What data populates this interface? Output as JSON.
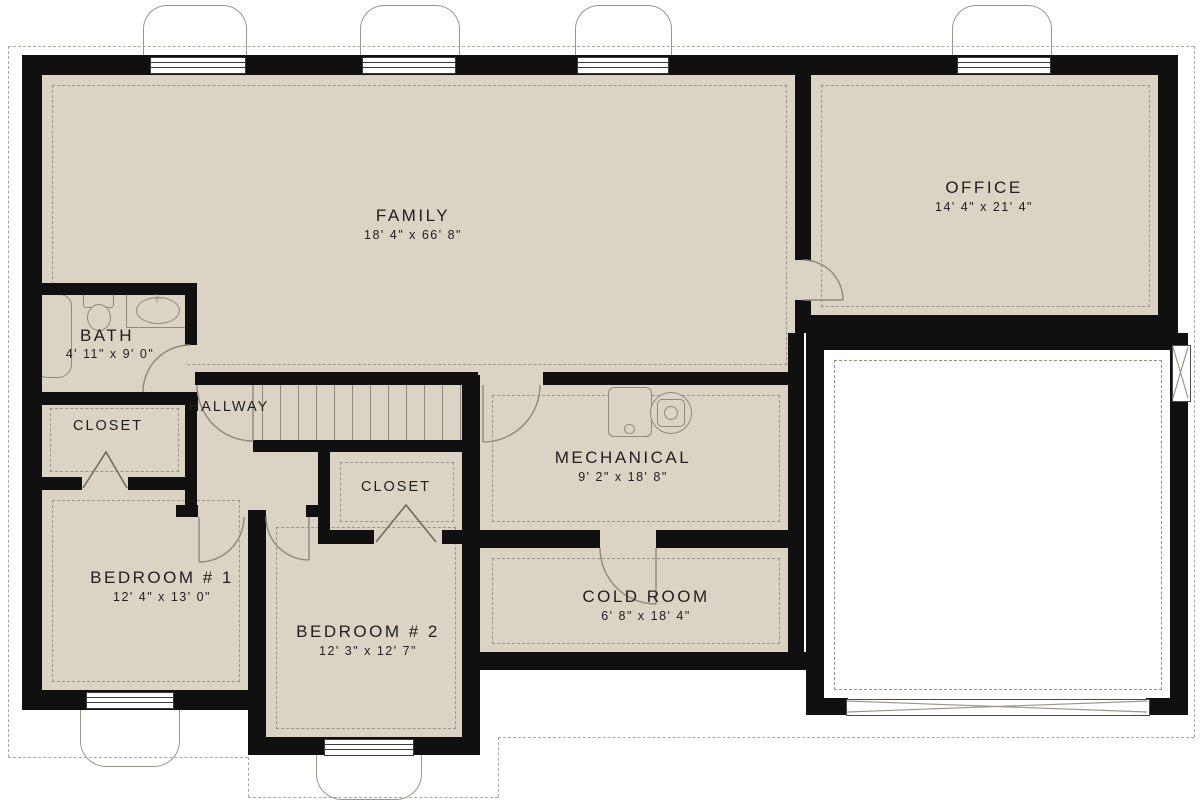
{
  "plan": {
    "type": "basement floor plan",
    "rooms": {
      "family": {
        "name": "FAMILY",
        "dims": "18' 4\" x 66' 8\""
      },
      "office": {
        "name": "OFFICE",
        "dims": "14' 4\" x 21' 4\""
      },
      "bath": {
        "name": "BATH",
        "dims": "4' 11\" x 9' 0\""
      },
      "closet_left": {
        "name": "CLOSET"
      },
      "hallway": {
        "name": "HALLWAY"
      },
      "closet_middle": {
        "name": "CLOSET"
      },
      "mechanical": {
        "name": "MECHANICAL",
        "dims": "9' 2\" x 18' 8\""
      },
      "bedroom1": {
        "name": "BEDROOM # 1",
        "dims": "12' 4\" x 13' 0\""
      },
      "bedroom2": {
        "name": "BEDROOM # 2",
        "dims": "12' 3\" x 12' 7\""
      },
      "cold_room": {
        "name": "COLD ROOM",
        "dims": "6' 8\" x 18' 4\""
      }
    },
    "colors": {
      "floor": "#dbd3c4",
      "wall": "#101010",
      "fixture_line": "#8e897c",
      "dashed_line": "#a9a9a0",
      "text": "#1f1f1f",
      "background": "#ffffff"
    }
  }
}
